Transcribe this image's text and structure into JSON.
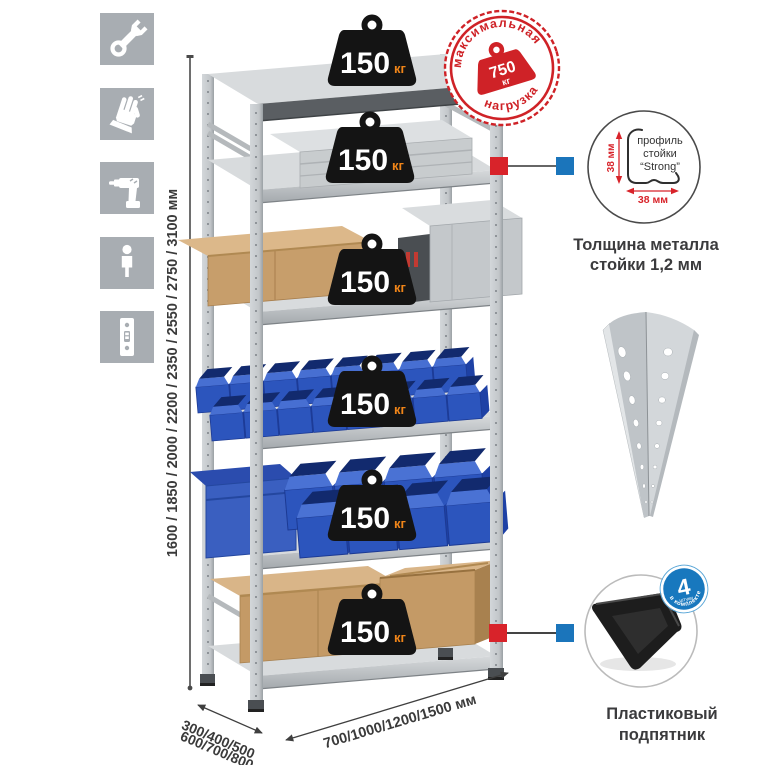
{
  "tool_icons": {
    "items": [
      {
        "name": "wrench"
      },
      {
        "name": "gloves"
      },
      {
        "name": "drill"
      },
      {
        "name": "person"
      },
      {
        "name": "rack-post-profile"
      }
    ]
  },
  "dimensions": {
    "height": "1600 / 1850 / 2000 / 2200 / 2350 / 2550 / 2750 / 3100 мм",
    "depth_top": "300/400/500",
    "depth_bottom": "600/700/800 мм",
    "width": "700/1000/1200/1500 мм"
  },
  "rack": {
    "shelf_count": 6,
    "badges": [
      {
        "value": "150",
        "unit": "кг"
      },
      {
        "value": "150",
        "unit": "кг"
      },
      {
        "value": "150",
        "unit": "кг"
      },
      {
        "value": "150",
        "unit": "кг"
      },
      {
        "value": "150",
        "unit": "кг"
      },
      {
        "value": "150",
        "unit": "кг"
      }
    ]
  },
  "max_load_stamp": {
    "arc_top": "максимальная",
    "arc_bottom": "нагрузка",
    "value": "750",
    "unit": "кг"
  },
  "profile_detail": {
    "label_line1": "профиль",
    "label_line2": "стойки",
    "label_line3": "“Strong”",
    "dim_vertical": "38 мм",
    "dim_horizontal": "38 мм",
    "caption_line1": "Толщина металла",
    "caption_line2": "стойки 1,2 мм"
  },
  "foot_detail": {
    "badge_value": "4",
    "badge_sub": "штуки",
    "badge_arc": "в комплекте",
    "caption_line1": "Пластиковый",
    "caption_line2": "подпятник"
  },
  "colors": {
    "accent_red": "#d8232a",
    "accent_blue": "#1b75bb",
    "stamp_red": "#cf2227",
    "badge_black": "#141414",
    "unit_orange": "#f08519",
    "icon_gray": "#a8adb2",
    "bin_blue": "#2c55bd",
    "cardboard": "#c49a66"
  }
}
